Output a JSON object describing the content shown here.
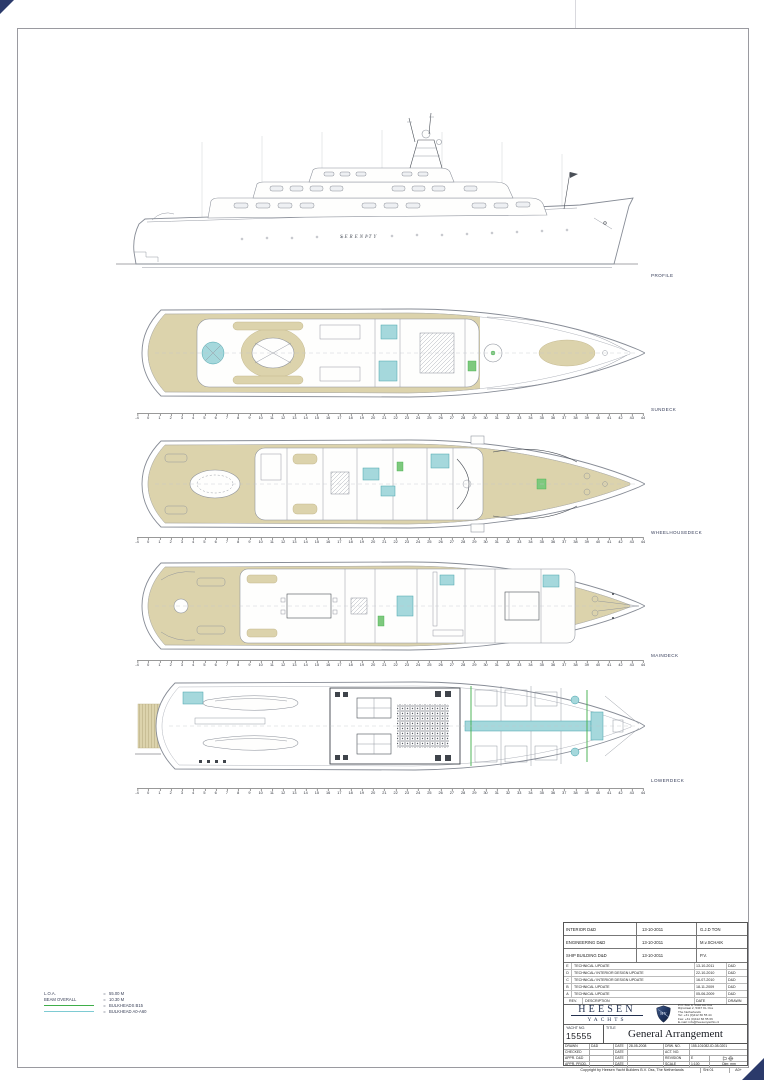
{
  "page": {
    "profile": {
      "label": "PROFILE",
      "yacht_name": "SERENITY"
    },
    "decks": [
      {
        "label": "SUNDECK"
      },
      {
        "label": "WHEELHOUSEDECK"
      },
      {
        "label": "MAINDECK"
      },
      {
        "label": "LOWERDECK"
      }
    ],
    "frame_ruler_labels": [
      "-4",
      "0",
      "1",
      "2",
      "3",
      "4",
      "5",
      "6",
      "7",
      "8",
      "9",
      "10",
      "11",
      "12",
      "13",
      "14",
      "15",
      "16",
      "17",
      "18",
      "19",
      "20",
      "21",
      "22",
      "23",
      "24",
      "25",
      "26",
      "27",
      "28",
      "29",
      "30",
      "31",
      "32",
      "33",
      "34",
      "35",
      "36",
      "37",
      "38",
      "39",
      "40",
      "41",
      "42",
      "43",
      "44"
    ]
  },
  "legend": {
    "rows": [
      {
        "label": "L.O.A.",
        "eq": "=",
        "value": "55.00 M",
        "swatch": null
      },
      {
        "label": "BEAM OVERALL",
        "eq": "=",
        "value": "10.30 M",
        "swatch": null
      },
      {
        "label": "",
        "eq": "=",
        "value": "BULKHEADS B15",
        "swatch": "#3fae49"
      },
      {
        "label": "",
        "eq": "=",
        "value": "BULKHEAD A0-A60",
        "swatch": "#7ecbd3"
      }
    ]
  },
  "title_block": {
    "info_rows": [
      {
        "label": "INTERIOR D&D",
        "date": "13-10-2011",
        "name": "G.J.D TON"
      },
      {
        "label": "ENGINEERING D&D",
        "date": "13-10-2011",
        "name": "M.v.SCHAIK"
      },
      {
        "label": "SHIP BUILDING D&D",
        "date": "13-10-2011",
        "name": "P.V."
      }
    ],
    "revisions": [
      {
        "rev": "E",
        "description": "TECHNICAL UPDATE",
        "date": "13-10-2011",
        "drawn": "D&D"
      },
      {
        "rev": "D",
        "description": "TECHNICAL/ INTERIOR DESIGN UPDATE",
        "date": "22-10-2010",
        "drawn": "D&D"
      },
      {
        "rev": "C",
        "description": "TECHNICAL/ INTERIOR DESIGN UPDATE",
        "date": "16-07-2010",
        "drawn": "D&D"
      },
      {
        "rev": "B",
        "description": "TECHNICAL UPDATE",
        "date": "18-11-2009",
        "drawn": "D&D"
      },
      {
        "rev": "A",
        "description": "TECHNICAL UPDATE",
        "date": "05-06-2009",
        "drawn": "D&D"
      }
    ],
    "revision_header": {
      "rev": "REV.",
      "description": "DESCRIPTION",
      "date": "DATE",
      "drawn": "DRAWN"
    },
    "company": {
      "name_line1": "HEESEN",
      "name_line2": "YACHTS",
      "address_lines": [
        "P.O. Box 8, 5340 AA Oss",
        "Rijnstraat 2, 5347 KL Oss",
        "The Netherlands",
        "Tel: +31 (0)412 66 55 44",
        "Fax: +31 (0)412 66 55 66",
        "E-mail: info@heesenyachts.nl"
      ]
    },
    "yacht_no_label": "YACHT NO.",
    "yacht_no": "15555",
    "title_label": "TITLE",
    "title": "General Arrangement",
    "fields": {
      "row1": {
        "label": "DRAWN",
        "value": "D&D",
        "date_label": "DATE",
        "date": "28-05-2008",
        "right_label": "DRW. NO.",
        "right_value": "155-101082-ID-08-0201"
      },
      "row2": {
        "label": "CHECKED",
        "value": "",
        "date_label": "DATE",
        "date": "",
        "right_label": "ACT. NO.",
        "right_value": ""
      },
      "row3": {
        "label": "APPR. D&D",
        "value": "",
        "date_label": "DATE",
        "date": "",
        "right_label": "REVISION",
        "right_value": "E"
      },
      "row4": {
        "label": "APPR. PROD.",
        "value": "",
        "date_label": "DATE",
        "date": "",
        "right_label": "SCALE",
        "right_value": "1:100",
        "extra": "Dim: mm"
      }
    },
    "copyright": {
      "text": "Copyright by Heesen Yacht Builders B.V. Oss, The Netherlands",
      "sheet": "Sht 01",
      "size": "A0+"
    }
  },
  "colors": {
    "teak": "#dcd3ab",
    "cyan": "#7ecbd3",
    "green": "#3fae49",
    "navy": "#2b3a6b"
  }
}
